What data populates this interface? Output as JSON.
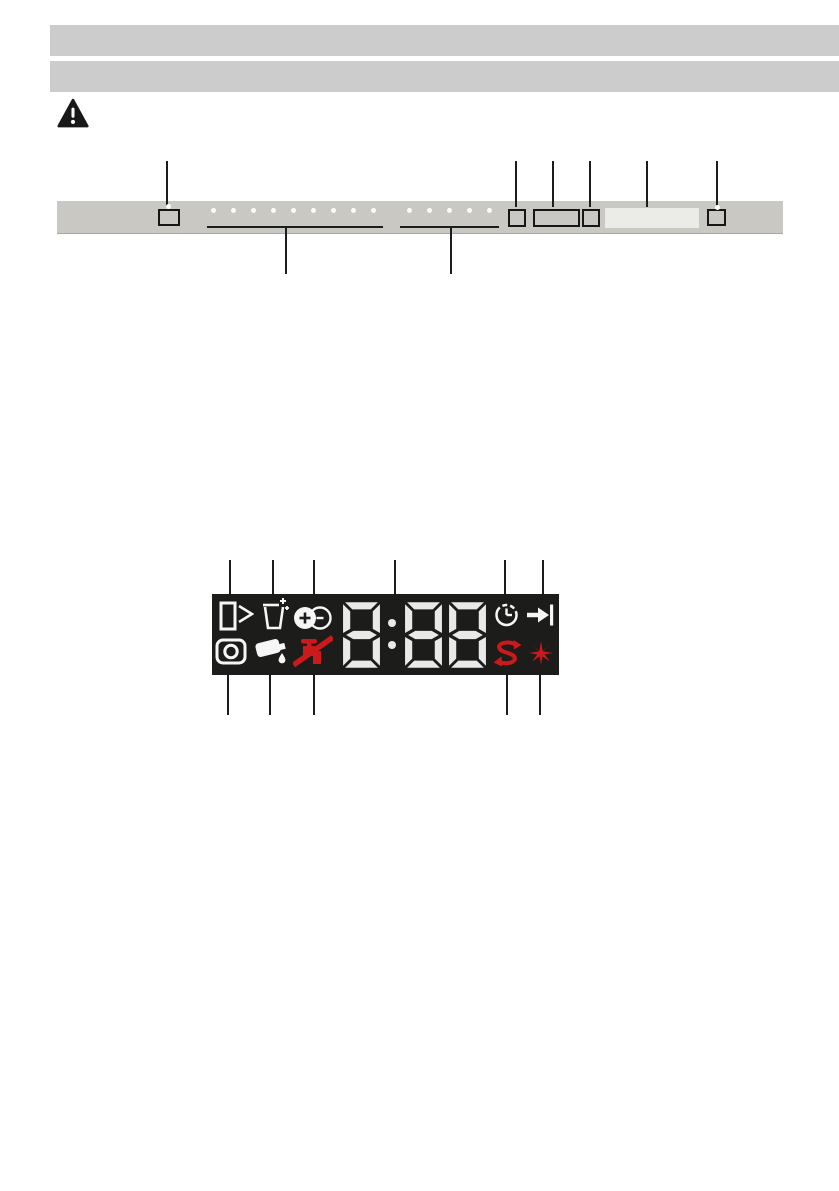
{
  "page": {
    "width": 839,
    "height": 1191
  },
  "colors": {
    "page_bg": "#ffffff",
    "header_bar": "#cccccc",
    "panel_bar": "#c9c8c2",
    "panel_edge": "#a9a8a2",
    "button_outline": "#161616",
    "led": "#ffffff",
    "window": "#ebebe8",
    "callout": "#1c1c1c",
    "display_bg": "#1c1c1a",
    "icon_white": "#f6f6f6",
    "icon_red": "#cb191c",
    "digit": "#e9e9e9"
  },
  "header": {
    "bar1_text": "",
    "bar2_text": ""
  },
  "warning": {
    "symbol": "exclamation-triangle"
  },
  "control_panel": {
    "buttons": [
      "on-off-button",
      "small-button",
      "wide-button",
      "small-button",
      "display-window",
      "start-button"
    ],
    "programme_leds": {
      "row1": {
        "count": 9,
        "x0": 213,
        "step": 20,
        "y": 210
      },
      "row2": {
        "count": 5,
        "x0": 409,
        "step": 20,
        "y": 210
      }
    },
    "button_leds": [
      {
        "x": 168,
        "y": 206
      },
      {
        "x": 717,
        "y": 207
      }
    ],
    "underlines": [
      {
        "x1": 207,
        "x2": 383,
        "y": 226
      },
      {
        "x1": 400,
        "x2": 499,
        "y": 226
      }
    ],
    "callouts_top": {
      "y1": 161,
      "y2": 207,
      "xs": [
        167,
        516,
        553,
        590,
        647,
        717
      ]
    },
    "callouts_bottom": {
      "y1": 228,
      "y2": 274,
      "xs": [
        286,
        451
      ]
    }
  },
  "display_panel": {
    "digits_value": "8:88",
    "indicators_top": [
      "door-open",
      "salt-refill",
      "rinse-aid-level",
      "time-digits",
      "delay-time",
      "programme-end"
    ],
    "indicators_bottom": [
      "programme-phase",
      "rinse-aid-refill",
      "water-supply-off",
      "extra-rinse",
      "spray-burst"
    ],
    "callouts_top": {
      "y1": 560,
      "y2": 598,
      "xs": [
        230,
        273,
        314,
        395,
        505,
        543
      ]
    },
    "callouts_bottom": {
      "y1": 672,
      "y2": 715,
      "xs": [
        228,
        270,
        314,
        507,
        540
      ]
    }
  }
}
